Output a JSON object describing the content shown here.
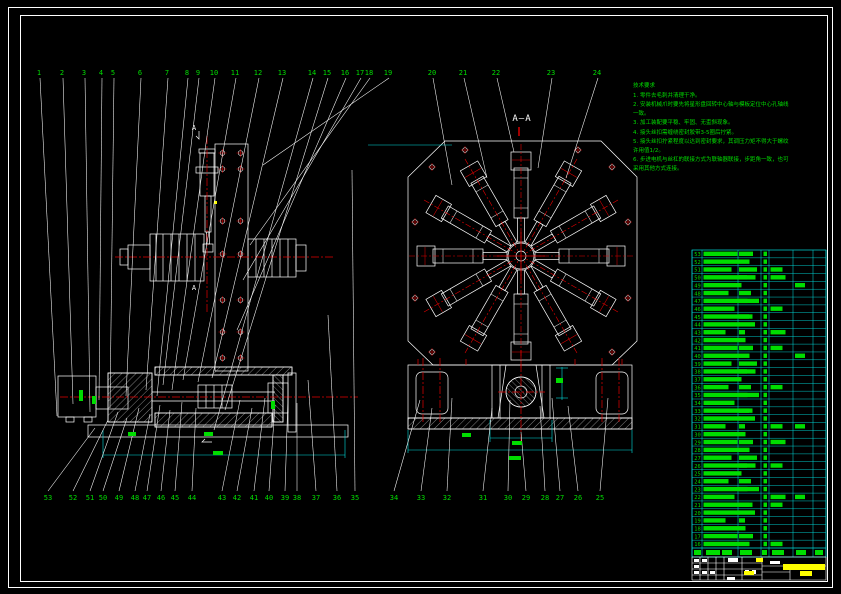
{
  "meta": {
    "type": "cad-assembly-drawing",
    "views": [
      "front-view",
      "section-A-A"
    ],
    "sheet_bg": "#000000"
  },
  "colors": {
    "background": "#000000",
    "geometry_line": "#ffffff",
    "centerline": "#e60000",
    "dimension": "#00dfdf",
    "callout_text": "#00dd00",
    "notes_text": "#00dd00",
    "title_text": "#ffff00"
  },
  "section_label": "A—A",
  "section_mark": "A",
  "notes": {
    "title": "技术要求",
    "lines": [
      "1. 零件去毛刺并清理干净。",
      "2. 安装机械爪时要先将星形盘回转中心轴与模板定位中心孔轴线一致。",
      "3. 加工装配要平稳、牢固、无歪斜现象。",
      "4. 接头丝扣需缠绕密封胶带3-5圈后拧紧。",
      "5. 接头丝扣拧紧程度以达到密封要求，其调压力矩不得大于螺纹许用值1/2。",
      "6. 步进电机与丝杠的联接方式为联轴器联接，步距角一致，也可采用其他方式连接。"
    ]
  },
  "callouts": [
    {
      "n": "1",
      "x": 39,
      "y": 72,
      "tx": 57,
      "ty": 416
    },
    {
      "n": "2",
      "x": 62,
      "y": 72,
      "tx": 73,
      "ty": 404
    },
    {
      "n": "3",
      "x": 84,
      "y": 72,
      "tx": 90,
      "ty": 412
    },
    {
      "n": "4",
      "x": 101,
      "y": 72,
      "tx": 99,
      "ty": 400
    },
    {
      "n": "5",
      "x": 113,
      "y": 72,
      "tx": 110,
      "ty": 408
    },
    {
      "n": "6",
      "x": 140,
      "y": 72,
      "tx": 126,
      "ty": 396
    },
    {
      "n": "7",
      "x": 167,
      "y": 72,
      "tx": 146,
      "ty": 390
    },
    {
      "n": "8",
      "x": 187,
      "y": 72,
      "tx": 157,
      "ty": 396
    },
    {
      "n": "9",
      "x": 198,
      "y": 72,
      "tx": 163,
      "ty": 385
    },
    {
      "n": "10",
      "x": 214,
      "y": 72,
      "tx": 172,
      "ty": 390
    },
    {
      "n": "11",
      "x": 235,
      "y": 72,
      "tx": 183,
      "ty": 380
    },
    {
      "n": "12",
      "x": 258,
      "y": 72,
      "tx": 198,
      "ty": 382
    },
    {
      "n": "13",
      "x": 282,
      "y": 72,
      "tx": 212,
      "ty": 378
    },
    {
      "n": "14",
      "x": 312,
      "y": 72,
      "tx": 214,
      "ty": 430
    },
    {
      "n": "15",
      "x": 327,
      "y": 72,
      "tx": 225,
      "ty": 410
    },
    {
      "n": "16",
      "x": 345,
      "y": 72,
      "tx": 237,
      "ty": 330
    },
    {
      "n": "17",
      "x": 360,
      "y": 72,
      "tx": 243,
      "ty": 280
    },
    {
      "n": "18",
      "x": 369,
      "y": 72,
      "tx": 250,
      "ty": 245
    },
    {
      "n": "19",
      "x": 388,
      "y": 72,
      "tx": 263,
      "ty": 165
    },
    {
      "n": "20",
      "x": 432,
      "y": 72,
      "tx": 452,
      "ty": 185
    },
    {
      "n": "21",
      "x": 463,
      "y": 72,
      "tx": 487,
      "ty": 178
    },
    {
      "n": "22",
      "x": 496,
      "y": 72,
      "tx": 514,
      "ty": 152
    },
    {
      "n": "23",
      "x": 551,
      "y": 72,
      "tx": 538,
      "ty": 168
    },
    {
      "n": "24",
      "x": 597,
      "y": 72,
      "tx": 566,
      "ty": 178
    },
    {
      "n": "53",
      "x": 48,
      "y": 497,
      "tx": 95,
      "ty": 428
    },
    {
      "n": "52",
      "x": 73,
      "y": 497,
      "tx": 108,
      "ty": 420
    },
    {
      "n": "51",
      "x": 90,
      "y": 497,
      "tx": 118,
      "ty": 412
    },
    {
      "n": "50",
      "x": 103,
      "y": 497,
      "tx": 127,
      "ty": 418
    },
    {
      "n": "49",
      "x": 119,
      "y": 497,
      "tx": 139,
      "ty": 408
    },
    {
      "n": "48",
      "x": 135,
      "y": 497,
      "tx": 150,
      "ty": 414
    },
    {
      "n": "47",
      "x": 147,
      "y": 497,
      "tx": 160,
      "ty": 405
    },
    {
      "n": "46",
      "x": 161,
      "y": 497,
      "tx": 170,
      "ty": 410
    },
    {
      "n": "45",
      "x": 175,
      "y": 497,
      "tx": 182,
      "ty": 402
    },
    {
      "n": "44",
      "x": 192,
      "y": 497,
      "tx": 196,
      "ty": 408
    },
    {
      "n": "43",
      "x": 222,
      "y": 497,
      "tx": 240,
      "ty": 400
    },
    {
      "n": "42",
      "x": 237,
      "y": 497,
      "tx": 252,
      "ty": 408
    },
    {
      "n": "41",
      "x": 254,
      "y": 497,
      "tx": 265,
      "ty": 398
    },
    {
      "n": "40",
      "x": 269,
      "y": 497,
      "tx": 275,
      "ty": 405
    },
    {
      "n": "39",
      "x": 285,
      "y": 497,
      "tx": 288,
      "ty": 396
    },
    {
      "n": "38",
      "x": 297,
      "y": 497,
      "tx": 297,
      "ty": 403
    },
    {
      "n": "37",
      "x": 316,
      "y": 497,
      "tx": 308,
      "ty": 380
    },
    {
      "n": "36",
      "x": 337,
      "y": 497,
      "tx": 328,
      "ty": 315
    },
    {
      "n": "35",
      "x": 355,
      "y": 497,
      "tx": 352,
      "ty": 170
    },
    {
      "n": "34",
      "x": 394,
      "y": 497,
      "tx": 420,
      "ty": 400
    },
    {
      "n": "33",
      "x": 421,
      "y": 497,
      "tx": 432,
      "ty": 408
    },
    {
      "n": "32",
      "x": 447,
      "y": 497,
      "tx": 452,
      "ty": 398
    },
    {
      "n": "31",
      "x": 483,
      "y": 497,
      "tx": 492,
      "ty": 408
    },
    {
      "n": "30",
      "x": 508,
      "y": 497,
      "tx": 510,
      "ty": 400
    },
    {
      "n": "29",
      "x": 526,
      "y": 497,
      "tx": 521,
      "ty": 432
    },
    {
      "n": "28",
      "x": 545,
      "y": 497,
      "tx": 540,
      "ty": 406
    },
    {
      "n": "27",
      "x": 560,
      "y": 497,
      "tx": 552,
      "ty": 398
    },
    {
      "n": "26",
      "x": 578,
      "y": 497,
      "tx": 568,
      "ty": 406
    },
    {
      "n": "25",
      "x": 600,
      "y": 497,
      "tx": 608,
      "ty": 398
    }
  ],
  "bom": {
    "left": 692,
    "right": 826,
    "top": 250,
    "header_top": 548,
    "header_bottom": 557,
    "col_lines": [
      692,
      702,
      738,
      761,
      769,
      793,
      813,
      826
    ],
    "row_note": "part rows; text illegible at source resolution, rendered as blocks",
    "rows": [
      [
        53,
        34,
        14,
        0,
        0
      ],
      [
        52,
        46,
        0,
        0,
        0
      ],
      [
        51,
        28,
        18,
        12,
        0
      ],
      [
        50,
        52,
        8,
        15,
        0
      ],
      [
        49,
        38,
        0,
        0,
        10
      ],
      [
        48,
        25,
        12,
        0,
        0
      ],
      [
        47,
        44,
        20,
        0,
        0
      ],
      [
        46,
        31,
        0,
        12,
        0
      ],
      [
        45,
        49,
        10,
        0,
        0
      ],
      [
        44,
        36,
        16,
        0,
        0
      ],
      [
        43,
        22,
        6,
        15,
        0
      ],
      [
        42,
        42,
        0,
        0,
        0
      ],
      [
        41,
        34,
        14,
        12,
        0
      ],
      [
        40,
        46,
        0,
        0,
        10
      ],
      [
        39,
        28,
        18,
        0,
        0
      ],
      [
        38,
        52,
        8,
        0,
        0
      ],
      [
        37,
        38,
        0,
        0,
        0
      ],
      [
        36,
        25,
        12,
        12,
        0
      ],
      [
        35,
        44,
        20,
        0,
        0
      ],
      [
        34,
        31,
        0,
        0,
        0
      ],
      [
        33,
        49,
        10,
        0,
        0
      ],
      [
        32,
        36,
        16,
        0,
        0
      ],
      [
        31,
        22,
        6,
        12,
        10
      ],
      [
        30,
        42,
        0,
        0,
        0
      ],
      [
        29,
        34,
        14,
        15,
        0
      ],
      [
        28,
        46,
        0,
        0,
        0
      ],
      [
        27,
        28,
        18,
        0,
        0
      ],
      [
        26,
        52,
        8,
        12,
        0
      ],
      [
        25,
        38,
        0,
        0,
        0
      ],
      [
        24,
        25,
        12,
        0,
        0
      ],
      [
        23,
        44,
        20,
        0,
        0
      ],
      [
        22,
        31,
        0,
        15,
        10
      ],
      [
        21,
        49,
        10,
        12,
        0
      ],
      [
        20,
        36,
        16,
        0,
        0
      ],
      [
        19,
        22,
        6,
        0,
        0
      ],
      [
        18,
        42,
        0,
        0,
        0
      ],
      [
        17,
        34,
        14,
        0,
        0
      ],
      [
        16,
        46,
        0,
        12,
        0
      ]
    ],
    "header_blocks": [
      [
        694,
        550,
        7,
        5
      ],
      [
        706,
        550,
        14,
        5
      ],
      [
        722,
        550,
        10,
        5
      ],
      [
        740,
        550,
        12,
        5
      ],
      [
        762,
        550,
        5,
        5
      ],
      [
        772,
        550,
        12,
        5
      ],
      [
        796,
        550,
        10,
        5
      ],
      [
        815,
        550,
        8,
        5
      ]
    ]
  },
  "title_block": {
    "white_blocks": [
      [
        694,
        559,
        5,
        3
      ],
      [
        702,
        559,
        5,
        3
      ],
      [
        728,
        558,
        10,
        4
      ],
      [
        694,
        565,
        5,
        3
      ],
      [
        694,
        571,
        5,
        3
      ],
      [
        702,
        571,
        5,
        3
      ],
      [
        710,
        571,
        5,
        3
      ],
      [
        745,
        570,
        4,
        4
      ],
      [
        752,
        570,
        4,
        4
      ],
      [
        727,
        577,
        8,
        3
      ],
      [
        770,
        561,
        10,
        3
      ]
    ],
    "yellow_blocks": [
      [
        756,
        558,
        7,
        4
      ],
      [
        783,
        564,
        42,
        6
      ],
      [
        800,
        571,
        12,
        5
      ],
      [
        744,
        571,
        10,
        4
      ]
    ]
  },
  "dim_marks": [
    [
      79,
      390,
      4,
      11
    ],
    [
      92,
      396,
      4,
      8
    ],
    [
      128,
      432,
      8,
      4
    ],
    [
      204,
      432,
      9,
      4
    ],
    [
      213,
      451,
      10,
      4
    ],
    [
      271,
      401,
      4,
      8
    ],
    [
      462,
      433,
      9,
      4
    ],
    [
      556,
      378,
      7,
      5
    ],
    [
      512,
      441,
      10,
      4
    ],
    [
      509,
      456,
      12,
      4
    ]
  ]
}
